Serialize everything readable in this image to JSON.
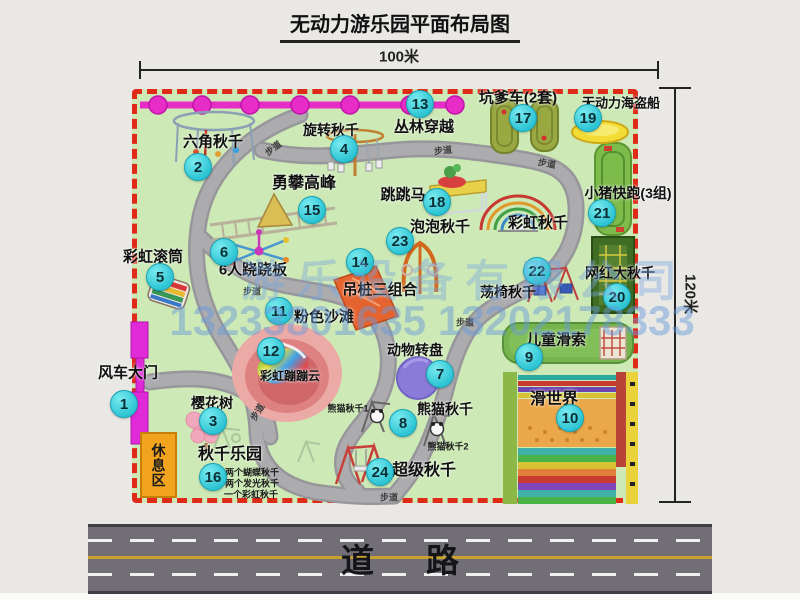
{
  "title": "无动力游乐园平面布局图",
  "dimensions": {
    "width_label": "100米",
    "height_label": "120米"
  },
  "watermark": {
    "company": "游乐设备有限公司",
    "phone": "13233801635 13202178333"
  },
  "road": {
    "label": "道路"
  },
  "rest_area": {
    "label": "休息区"
  },
  "park": {
    "accent_colors": {
      "border": "#e02a18",
      "badge": "#2cc3d3",
      "grass": "#cde9b6",
      "chain": "#e62ec6"
    },
    "items": [
      {
        "key": "windmill-gate",
        "num": 1,
        "label": "风车大门",
        "lx": 128,
        "ly": 373,
        "bx": 124,
        "by": 404,
        "s": 15
      },
      {
        "key": "hexagon-swing",
        "num": 2,
        "label": "六角秋千",
        "lx": 213,
        "ly": 142,
        "bx": 198,
        "by": 167,
        "s": 15
      },
      {
        "key": "cherry-tree",
        "num": 3,
        "label": "樱花树",
        "lx": 212,
        "ly": 403,
        "bx": 213,
        "by": 421,
        "s": 14
      },
      {
        "key": "rotating-swing",
        "num": 4,
        "label": "旋转秋千",
        "lx": 331,
        "ly": 130,
        "bx": 344,
        "by": 149,
        "s": 14
      },
      {
        "key": "rainbow-roller",
        "num": 5,
        "label": "彩虹滚筒",
        "lx": 153,
        "ly": 257,
        "bx": 160,
        "by": 277,
        "s": 15
      },
      {
        "key": "six-person-seesaw",
        "num": 6,
        "label": "6人跷跷板",
        "lx": 253,
        "ly": 270,
        "bx": 224,
        "by": 252,
        "s": 15
      },
      {
        "key": "animal-turntable",
        "num": 7,
        "label": "动物转盘",
        "lx": 415,
        "ly": 350,
        "bx": 440,
        "by": 374,
        "s": 14
      },
      {
        "key": "panda-swing",
        "num": 8,
        "label": "熊猫秋千",
        "lx": 445,
        "ly": 409,
        "bx": 403,
        "by": 423,
        "s": 14
      },
      {
        "key": "kids-zipline",
        "num": 9,
        "label": "儿童滑索",
        "lx": 556,
        "ly": 340,
        "bx": 529,
        "by": 357,
        "s": 15
      },
      {
        "key": "slide-world",
        "num": 10,
        "label": "滑世界",
        "lx": 554,
        "ly": 400,
        "bx": 570,
        "by": 418,
        "s": 16
      },
      {
        "key": "pink-beach",
        "num": 11,
        "label": "粉色沙滩",
        "lx": 324,
        "ly": 317,
        "bx": 279,
        "by": 311,
        "s": 15
      },
      {
        "key": "rainbow-bounce-cloud",
        "num": 12,
        "label": "彩虹蹦蹦云",
        "lx": 290,
        "ly": 376,
        "bx": 271,
        "by": 351,
        "s": 12
      },
      {
        "key": "jungle-crossing",
        "num": 13,
        "label": "丛林穿越",
        "lx": 424,
        "ly": 127,
        "bx": 420,
        "by": 104,
        "s": 15
      },
      {
        "key": "hanging-post-combo",
        "num": 14,
        "label": "吊桩三组合",
        "lx": 380,
        "ly": 290,
        "bx": 360,
        "by": 262,
        "s": 15
      },
      {
        "key": "climb-peak",
        "num": 15,
        "label": "勇攀高峰",
        "lx": 304,
        "ly": 184,
        "bx": 312,
        "by": 210,
        "s": 16
      },
      {
        "key": "swing-park",
        "num": 16,
        "label": "秋千乐园",
        "lx": 230,
        "ly": 455,
        "bx": 213,
        "by": 477,
        "s": 16
      },
      {
        "key": "pit-car",
        "num": 17,
        "label": "坑爹车(2套)",
        "lx": 518,
        "ly": 98,
        "bx": 523,
        "by": 118,
        "s": 15
      },
      {
        "key": "jumping-horse",
        "num": 18,
        "label": "跳跳马",
        "lx": 403,
        "ly": 195,
        "bx": 437,
        "by": 202,
        "s": 15
      },
      {
        "key": "pirate-ship",
        "num": 19,
        "label": "无动力海盗船",
        "lx": 621,
        "ly": 103,
        "bx": 588,
        "by": 118,
        "s": 13
      },
      {
        "key": "big-net-swing",
        "num": 20,
        "label": "网红大秋千",
        "lx": 620,
        "ly": 273,
        "bx": 617,
        "by": 297,
        "s": 14
      },
      {
        "key": "pig-run",
        "num": 21,
        "label": "小猪快跑(3组)",
        "lx": 628,
        "ly": 193,
        "bx": 602,
        "by": 213,
        "s": 14
      },
      {
        "key": "chair-swing",
        "num": 22,
        "label": "荡椅秋千",
        "lx": 508,
        "ly": 292,
        "bx": 537,
        "by": 271,
        "s": 14
      },
      {
        "key": "bubble-swing",
        "num": 23,
        "label": "泡泡秋千",
        "lx": 440,
        "ly": 227,
        "bx": 400,
        "by": 241,
        "s": 15
      },
      {
        "key": "super-swing",
        "num": 24,
        "label": "超级秋千",
        "lx": 424,
        "ly": 471,
        "bx": 380,
        "by": 472,
        "s": 16
      },
      {
        "key": "rainbow-arc-swing",
        "label": "彩虹秋千",
        "lx": 538,
        "ly": 223,
        "s": 15
      }
    ],
    "walkways": {
      "label": "步道",
      "positions": [
        {
          "x": 273,
          "y": 148,
          "r": -38
        },
        {
          "x": 443,
          "y": 150,
          "r": -6
        },
        {
          "x": 547,
          "y": 163,
          "r": 10
        },
        {
          "x": 252,
          "y": 291,
          "r": 0
        },
        {
          "x": 465,
          "y": 322,
          "r": 0
        },
        {
          "x": 257,
          "y": 412,
          "r": -58
        },
        {
          "x": 389,
          "y": 497,
          "r": 0
        }
      ]
    },
    "sub_labels": [
      {
        "key": "panda-swing-1-note",
        "label": "熊猫秋千1",
        "x": 348,
        "y": 408
      },
      {
        "key": "panda-swing-2-note",
        "label": "熊猫秋千2",
        "x": 448,
        "y": 446
      },
      {
        "key": "swing-park-note-1",
        "label": "两个蝴蝶秋千",
        "x": 252,
        "y": 472
      },
      {
        "key": "swing-park-note-2",
        "label": "两个发光秋千",
        "x": 252,
        "y": 483
      },
      {
        "key": "swing-park-note-3",
        "label": "一个彩虹秋千",
        "x": 251,
        "y": 494
      }
    ]
  }
}
